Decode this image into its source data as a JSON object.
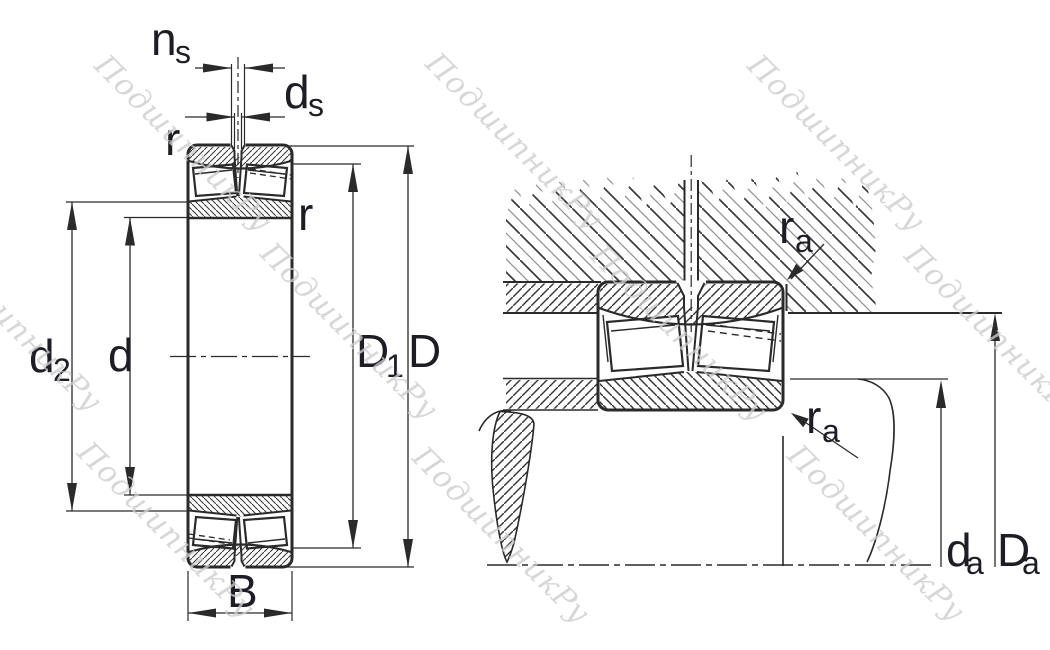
{
  "watermark": {
    "text": "ПодшипникРу"
  },
  "colors": {
    "background": "#ffffff",
    "line": "#2a2a2a",
    "label": "#1d1d26",
    "watermark": "#cccccc"
  },
  "left_view": {
    "labels": {
      "ns": {
        "base": "n",
        "sub": "s"
      },
      "ds": {
        "base": "d",
        "sub": "s"
      },
      "r_top": "r",
      "r_side": "r",
      "d2": {
        "base": "d",
        "sub": "2"
      },
      "d": "d",
      "D1": {
        "base": "D",
        "sub": "1"
      },
      "D": "D",
      "B": "B"
    }
  },
  "right_view": {
    "labels": {
      "ra_upper": {
        "base": "r",
        "sub": "a"
      },
      "ra_lower": {
        "base": "r",
        "sub": "a"
      },
      "da": {
        "base": "d",
        "sub": "a"
      },
      "Da": {
        "base": "D",
        "sub": "a"
      }
    }
  }
}
